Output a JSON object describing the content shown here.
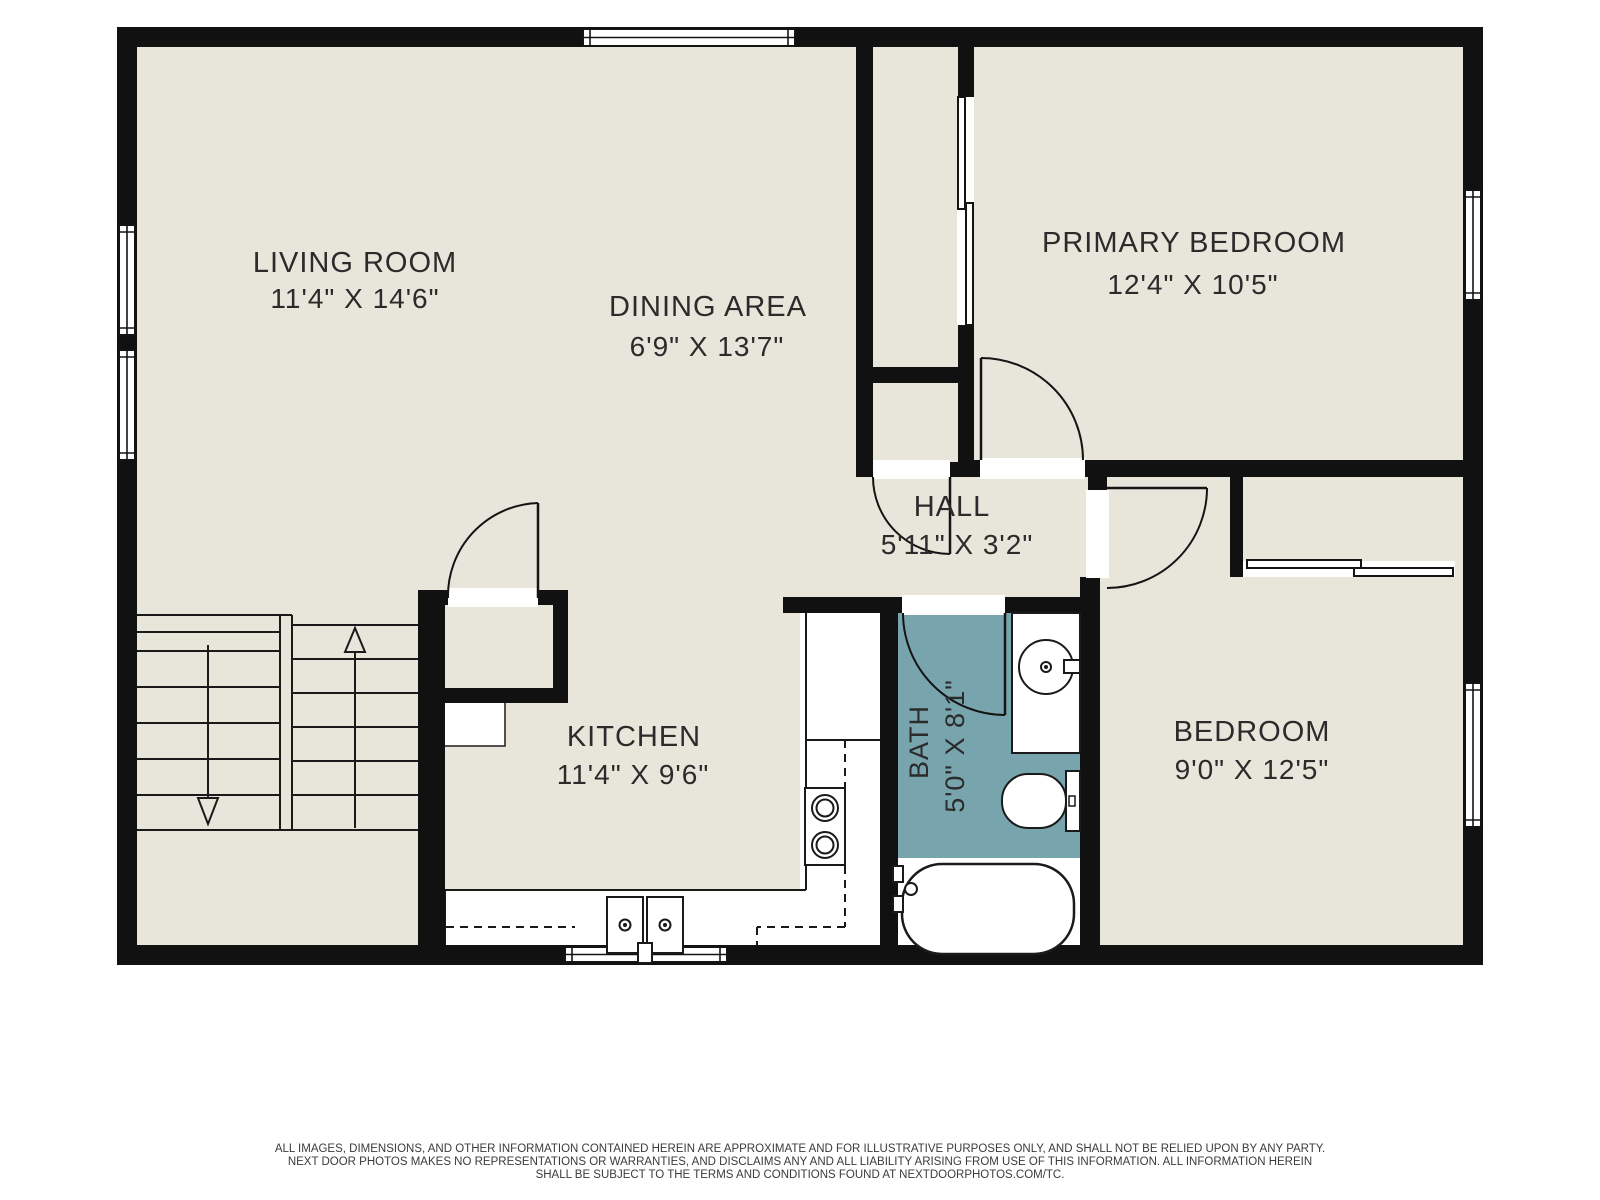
{
  "colors": {
    "floor": "#e8e5da",
    "wall": "#111111",
    "bath_floor": "#78a5ad",
    "line": "#1a1a1a",
    "label": "#2b2b2b",
    "paper": "#ffffff"
  },
  "rooms": {
    "living_room": {
      "name": "LIVING ROOM",
      "dims": "11'4\" X 14'6\""
    },
    "dining_area": {
      "name": "DINING AREA",
      "dims": "6'9\" X 13'7\""
    },
    "primary_bedroom": {
      "name": "PRIMARY BEDROOM",
      "dims": "12'4\" X 10'5\""
    },
    "hall": {
      "name": "HALL",
      "dims": "5'11\" X 3'2\""
    },
    "kitchen": {
      "name": "KITCHEN",
      "dims": "11'4\" X 9'6\""
    },
    "bath": {
      "name": "BATH",
      "dims": "5'0\" X 8'1\""
    },
    "bedroom": {
      "name": "BEDROOM",
      "dims": "9'0\" X 12'5\""
    }
  },
  "disclaimer": {
    "line1": "ALL IMAGES, DIMENSIONS, AND OTHER INFORMATION CONTAINED HEREIN ARE APPROXIMATE AND FOR ILLUSTRATIVE PURPOSES ONLY, AND SHALL NOT BE RELIED UPON BY ANY PARTY.",
    "line2": "NEXT DOOR PHOTOS MAKES NO REPRESENTATIONS OR WARRANTIES, AND DISCLAIMS ANY AND ALL LIABILITY ARISING FROM USE OF THIS INFORMATION. ALL INFORMATION HEREIN",
    "line3": "SHALL BE SUBJECT TO THE TERMS AND CONDITIONS FOUND AT NEXTDOORPHOTOS.COM/TC."
  }
}
